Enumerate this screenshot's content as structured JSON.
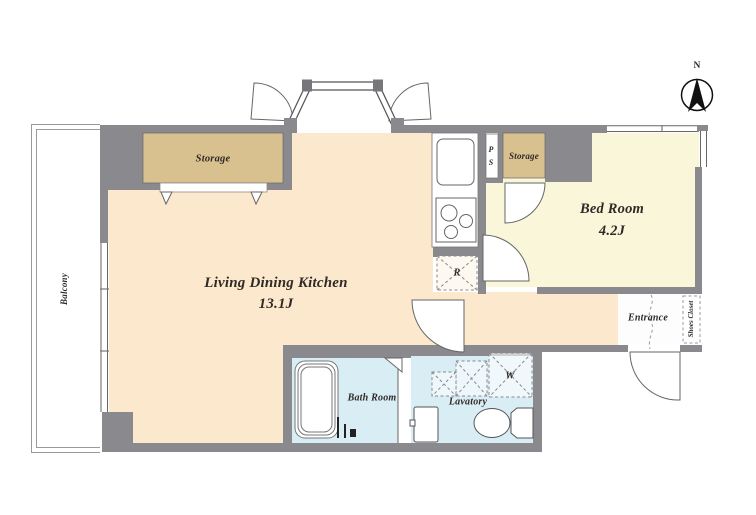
{
  "plan": {
    "compass_label": "N",
    "rooms": {
      "ldk": {
        "name": "Living Dining Kitchen",
        "size": "13.1J"
      },
      "bedroom": {
        "name": "Bed Room",
        "size": "4.2J"
      },
      "balcony": {
        "name": "Balcony"
      },
      "bathroom": {
        "name": "Bath Room"
      },
      "lavatory": {
        "name": "Lavatory"
      },
      "entrance": {
        "name": "Entrance"
      },
      "shoes_closet": {
        "name": "Shoes Closet"
      },
      "storage_left": {
        "name": "Storage"
      },
      "storage_right": {
        "name": "Storage"
      },
      "pipe_space": {
        "letters": [
          "P",
          "S"
        ]
      },
      "refrigerator_space": {
        "name": "R"
      },
      "washer_space": {
        "name": "W"
      }
    },
    "colors": {
      "wall": "#8a8a8e",
      "ldk_floor": "#fce9cd",
      "bedroom_floor": "#faf6da",
      "storage_fill": "#d9c08f",
      "wet_area_floor": "#d9edf5",
      "line": "#5a5a5e",
      "text": "#2f2a26"
    }
  }
}
